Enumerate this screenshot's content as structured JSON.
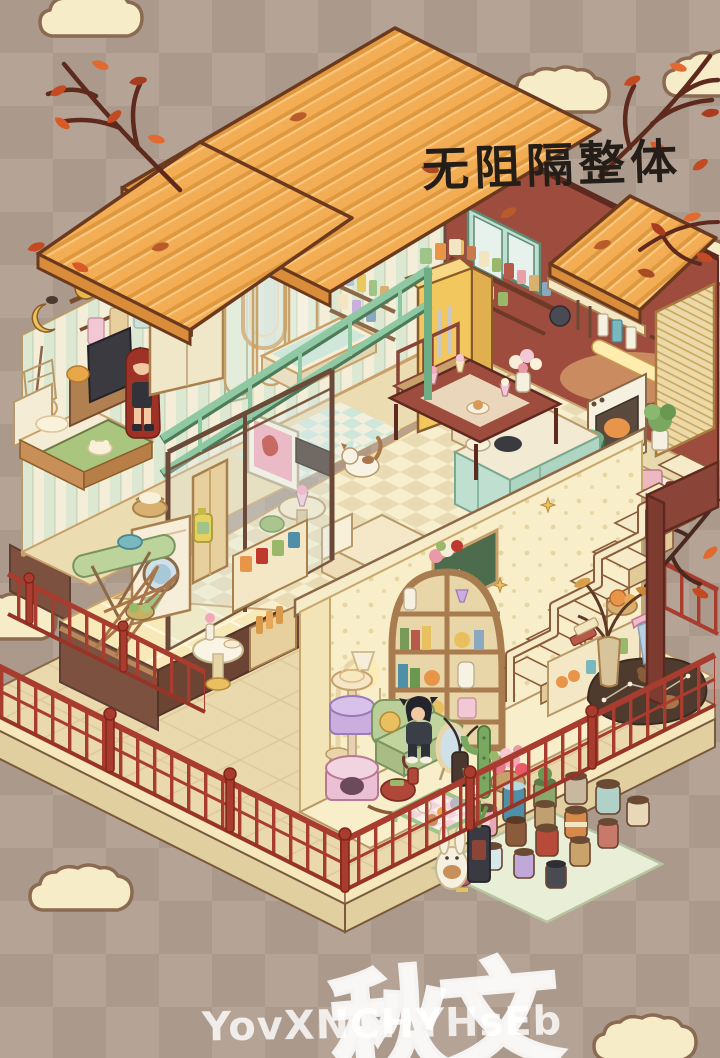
{
  "annotation": {
    "text": "无阻隔整体",
    "color": "#241d18"
  },
  "watermark": {
    "latin": "YovXNCHYHsEb",
    "stamp": "秋文",
    "color": "#ffffff"
  },
  "background": {
    "checker_colors": [
      "#b5a496",
      "#ab9a8c"
    ],
    "cloud_fill": "#f6edc8",
    "cloud_outline": "#8a6a50"
  },
  "palette": {
    "roof_orange": "#f3ad55",
    "roof_edge": "#d98c3a",
    "wall_maroon": "#9e4c3e",
    "wall_stripe_cream": "#f4edd8",
    "wall_stripe_mint": "#dde8d2",
    "fence_red": "#a83c2e",
    "deck_tan": "#ead9ad",
    "railing_mint": "#8fc9a3",
    "fridge_yellow": "#f2c75e",
    "wood_brown": "#a87c4e",
    "lower_wall_cream": "#f8eec9",
    "autumn_leaf": "#c44a22"
  },
  "rooms": [
    {
      "name": "bedroom",
      "objects": [
        "hanging-clothes-rack",
        "crescent-moon-decor",
        "hanging-chair",
        "bed",
        "tv-desk",
        "red-haired-character",
        "wardrobe"
      ]
    },
    {
      "name": "bathroom",
      "objects": [
        "arched-mirror",
        "shower-glass-panels",
        "gold-shower-head",
        "bathtub",
        "toiletry-shelf"
      ]
    },
    {
      "name": "kitchen",
      "objects": [
        "wall-cabinet",
        "spice-shelves",
        "utensil-rack",
        "bamboo-blind",
        "oven",
        "refrigerator",
        "counter-stove",
        "green-pot",
        "island-counter"
      ]
    },
    {
      "name": "living-dining",
      "objects": [
        "tv",
        "media-console",
        "cream-sofa",
        "side-table",
        "dining-table",
        "dining-chairs",
        "parfait-glasses",
        "flower-vase",
        "cat"
      ]
    },
    {
      "name": "laundry-deck",
      "objects": [
        "washing-machine",
        "laundry-basket",
        "detergent-bottle",
        "ironing-board",
        "drying-rack",
        "snack-shelf",
        "bottle-crate",
        "small-table"
      ]
    },
    {
      "name": "downstairs-lounge",
      "objects": [
        "arched-bookshelf",
        "chalkboard",
        "staircase",
        "cat-tower",
        "floor-lamp",
        "green-sofa",
        "black-haired-character",
        "rocking-horse",
        "pet-pen",
        "standing-mirror",
        "cactus",
        "flower-basket",
        "constellation-rug",
        "umbrella",
        "dried-branch-vase",
        "understairs-shelf"
      ]
    },
    {
      "name": "garden-deck",
      "objects": [
        "flower-pot-collection",
        "bunny-pot",
        "red-fence",
        "autumn-branches"
      ]
    }
  ]
}
